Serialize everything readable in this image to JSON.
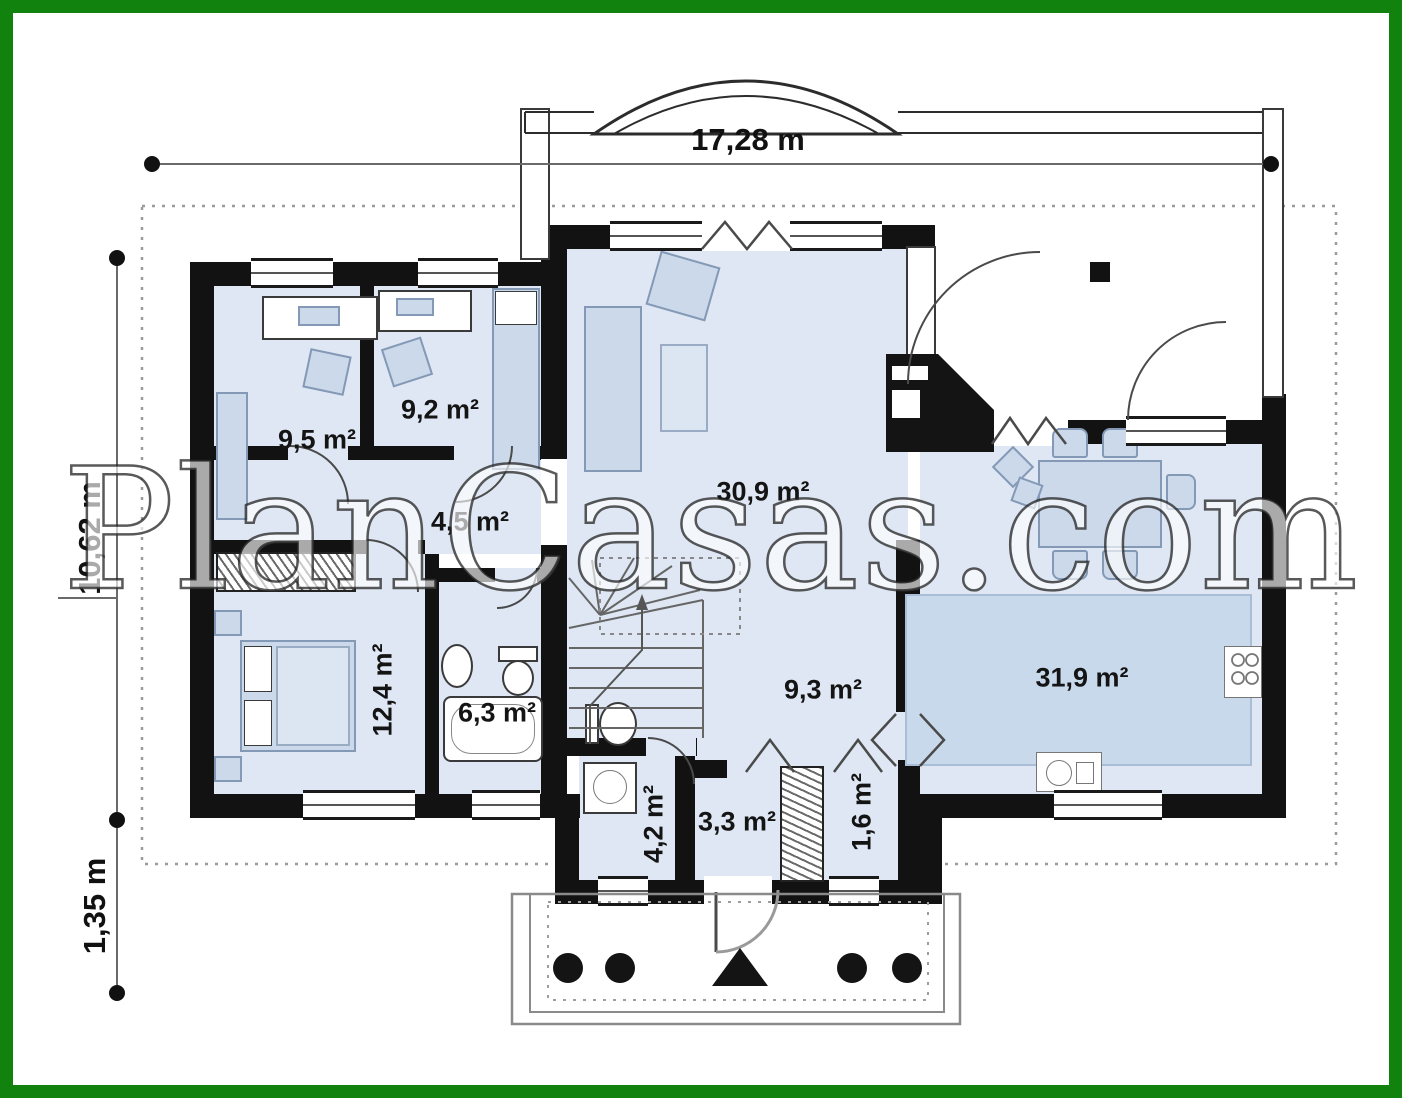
{
  "watermark": "PlanCasas.com",
  "dimensions": {
    "total_width": "17,28 m",
    "main_depth": "10,62 m",
    "porch_depth": "1,35 m"
  },
  "rooms": [
    {
      "id": "bedroom-a",
      "area": "9,5 m²"
    },
    {
      "id": "bedroom-b",
      "area": "9,2 m²"
    },
    {
      "id": "hallway",
      "area": "4,5 m²"
    },
    {
      "id": "living-room",
      "area": "30,9 m²"
    },
    {
      "id": "bedroom-c",
      "area": "12,4 m²"
    },
    {
      "id": "bathroom",
      "area": "6,3 m²"
    },
    {
      "id": "hall",
      "area": "9,3 m²"
    },
    {
      "id": "kitchen-dining",
      "area": "31,9 m²"
    },
    {
      "id": "wc",
      "area": "4,2 m²"
    },
    {
      "id": "vestibule",
      "area": "3,3 m²"
    },
    {
      "id": "closet",
      "area": "1,6 m²"
    }
  ],
  "colors": {
    "frame_green": "#12820f",
    "wall_black": "#121212",
    "room_fill": "#dee7f3",
    "furniture_fill": "#ccd9eb",
    "kitchen_zone_fill": "#c9d9ec"
  }
}
